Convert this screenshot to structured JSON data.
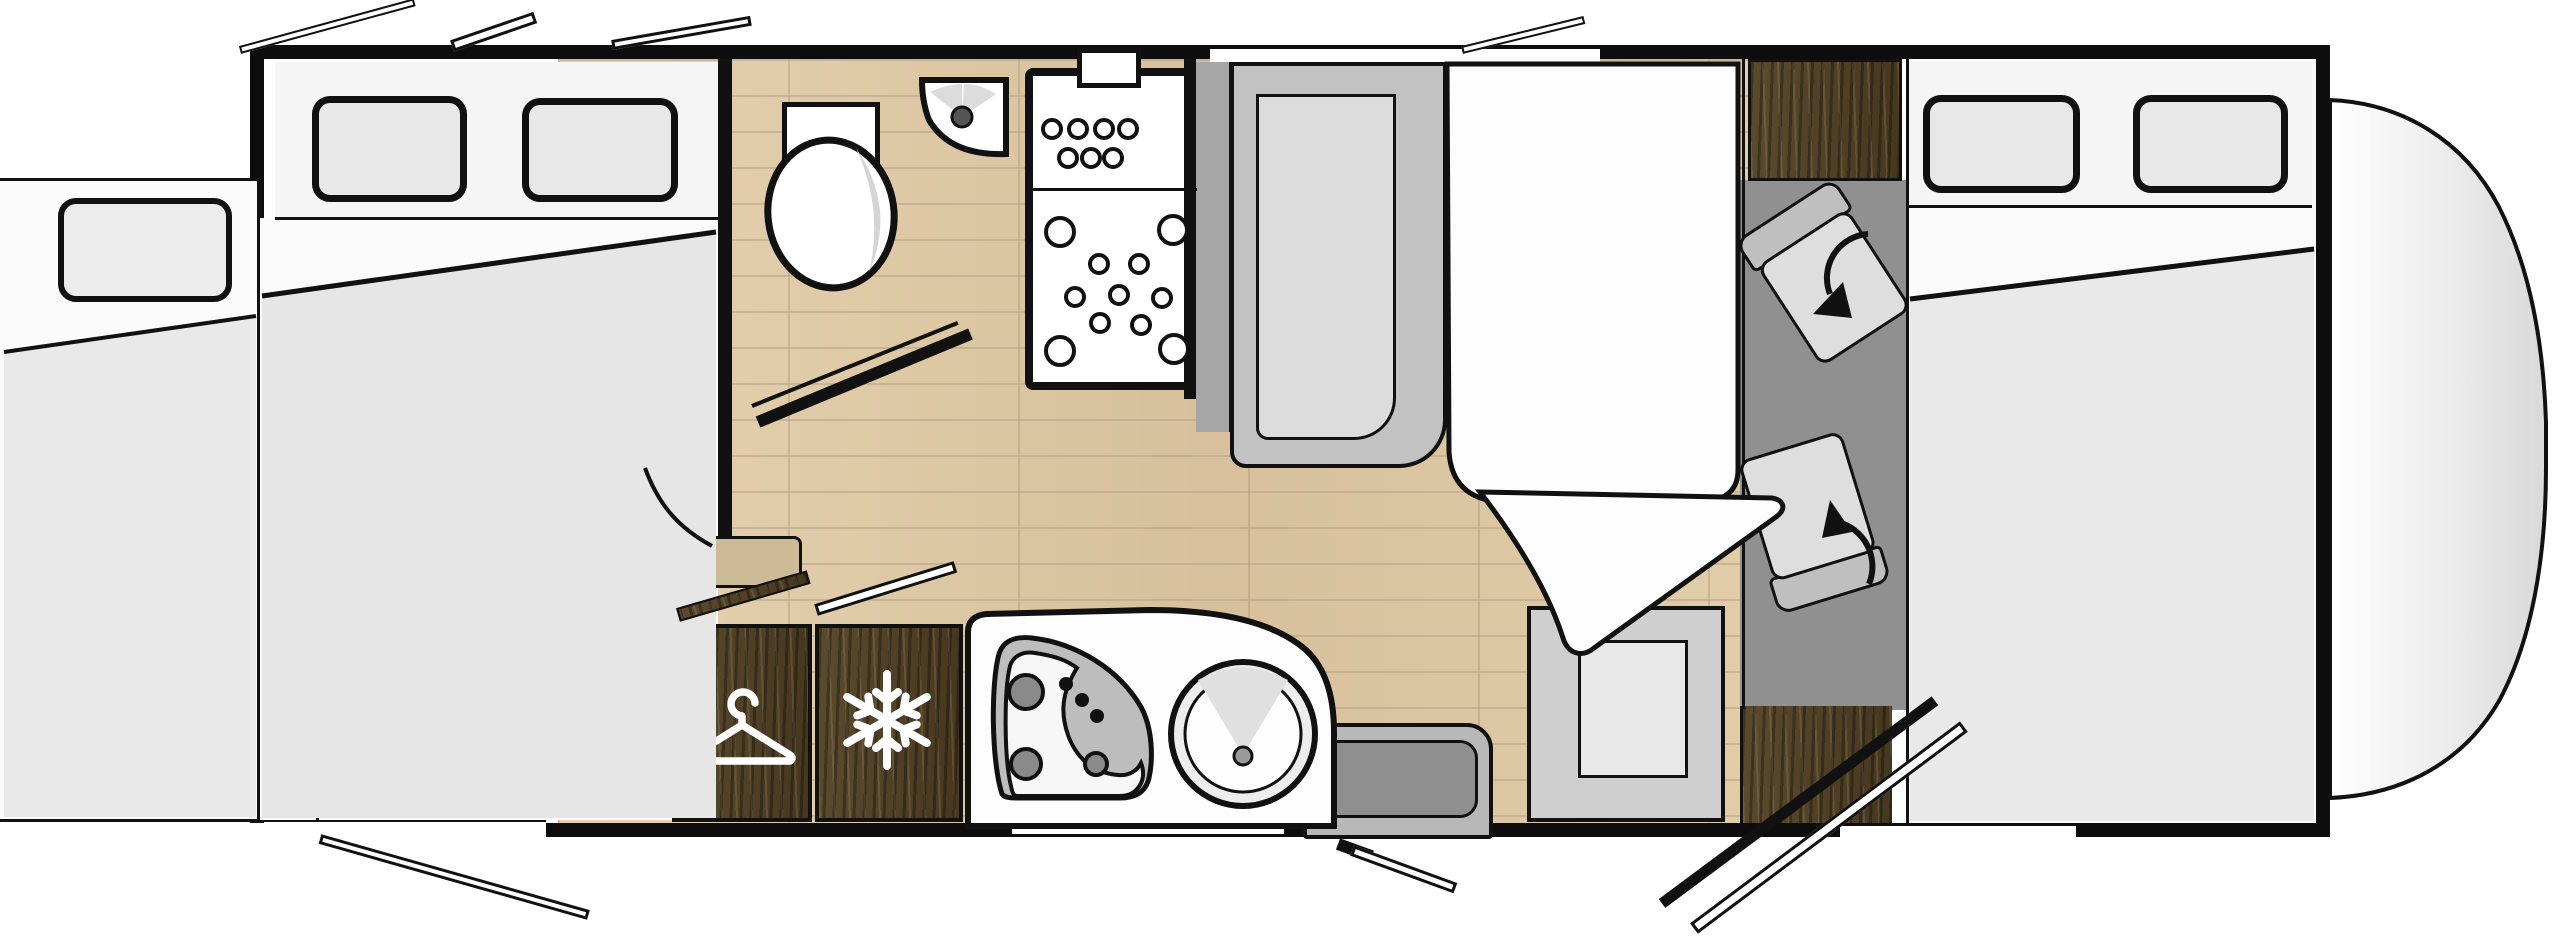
{
  "title": "Motorhome floor plan (top view)",
  "rooms": {
    "bedroom": {
      "aria": "Rear bedroom with slide-out twin beds",
      "window_count": 2,
      "items": [
        "slide-out bed box",
        "pillow",
        "duvet with folded sheet",
        "mattress split"
      ]
    },
    "bathroom": {
      "aria": "Bathroom",
      "items": [
        "toilet",
        "corner washbasin with tap",
        "shower tray with drain pattern",
        "open bathroom door"
      ]
    },
    "wardrobe": {
      "aria": "Wardrobe cabinet",
      "icon": "hanger-icon"
    },
    "fridge": {
      "aria": "Refrigerator / freezer cabinet",
      "icon": "snowflake-icon"
    },
    "kitchen": {
      "aria": "Kitchen block with 3-burner hob and round sink",
      "hob_burners": 3,
      "hob_knobs": 3,
      "sink": "round sink with tap"
    },
    "lounge": {
      "aria": "Lounge / dinette with drop-down bed",
      "items": [
        "forward-facing bench seat",
        "drop-down bed with folded corner",
        "dinette table",
        "side bench seat"
      ]
    },
    "cab": {
      "aria": "Driver cab with two swivel seats",
      "seat_count": 2,
      "overcab_bed": {
        "aria": "Front bed above cab",
        "window_count": 2
      }
    },
    "entrance": {
      "aria": "Entrance door shown open"
    },
    "open_windows": {
      "aria": "Opened window panel",
      "count": 5
    }
  },
  "colors": {
    "wall": "#111111",
    "floor_wood": "#dcc7a6",
    "cabinet_wood": "#4e4028",
    "duvet_gray": "#e7e7e7",
    "seat_gray": "#c2c2c2",
    "cab_floor_gray": "#909090",
    "counter_white": "#fdfdfd",
    "window_glass": "#e8e8e8"
  }
}
